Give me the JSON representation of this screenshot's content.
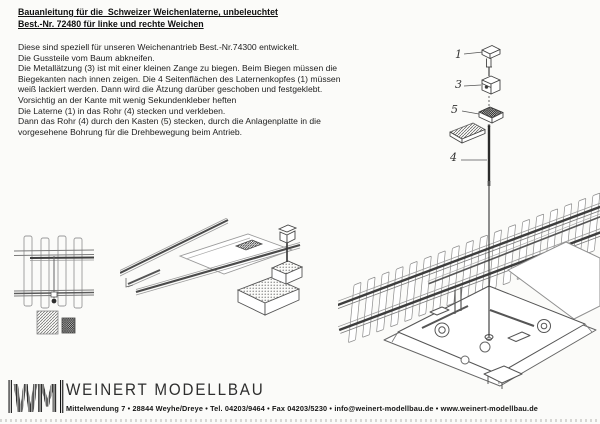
{
  "document": {
    "title_line1": "Bauanleitung für die  Schweizer Weichenlaterne, unbeleuchtet",
    "title_line2": "Best.-Nr. 72480 für linke und rechte Weichen",
    "body": "Diese sind speziell für unseren Weichenantrieb Best.-Nr.74300 entwickelt.\nDie Gussteile vom Baum abkneifen.\nDie Metallätzung (3) ist mit einer kleinen Zange zu biegen. Beim Biegen müssen die\nBiegekanten nach innen zeigen. Die 4 Seitenflächen des Laternenkopfes (1) müssen\nweiß lackiert werden. Dann wird die Ätzung darüber geschoben und festgeklebt.\nVorsichtig an der Kante mit wenig Sekundenkleber heften\nDie Laterne (1) in das Rohr (4) stecken und verkleben.\nDann das Rohr (4) durch den Kasten (5) stecken, durch die Anlagenplatte in die\nvorgesehene Bohrung für die Drehbewegung beim Antrieb."
  },
  "diagram": {
    "part_labels": [
      "1",
      "3",
      "5",
      "4"
    ]
  },
  "footer": {
    "logo_text": "WM",
    "company": "WEINERT MODELLBAU",
    "address": "Mittelwendung 7 • 28844 Weyhe/Dreye • Tel. 04203/9464 • Fax 04203/5230 • info@weinert-modellbau.de • www.weinert-modellbau.de"
  }
}
